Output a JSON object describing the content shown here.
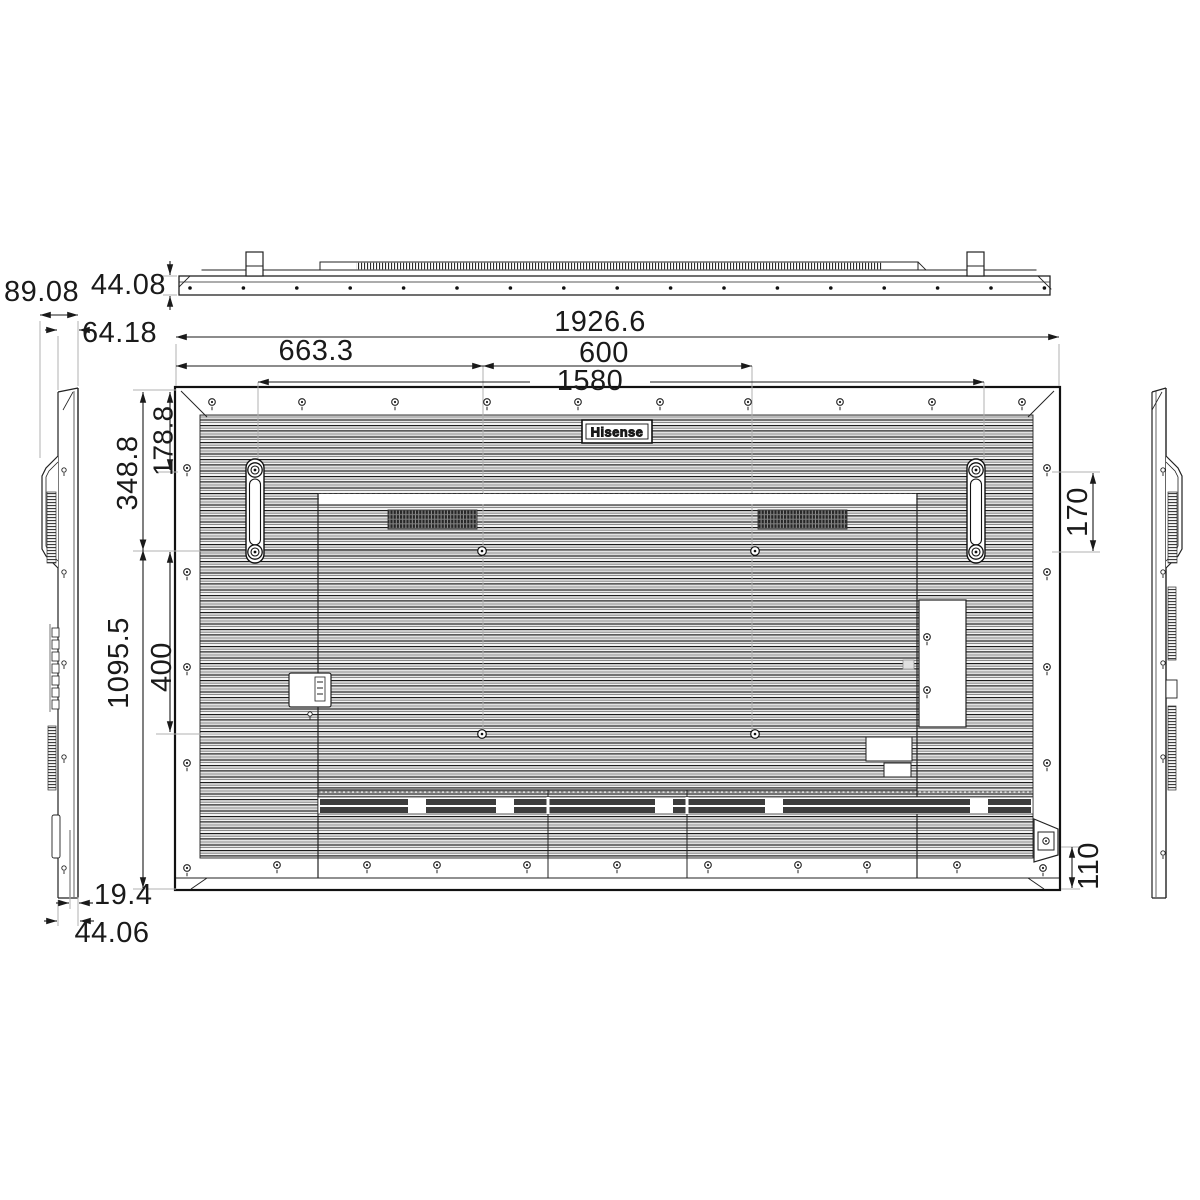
{
  "drawing": {
    "brand": "Hisense",
    "dims": {
      "top_thickness": "44.08",
      "side_depth_overall": "89.08",
      "side_depth_body": "64.18",
      "overall_width": "1926.6",
      "edge_to_vesa": "663.3",
      "vesa_width": "600",
      "handle_span": "1580",
      "top_to_handle_hole": "178.8",
      "top_to_vesa": "348.8",
      "vesa_height": "400",
      "overall_height": "1095.5",
      "handle_hole_pitch": "170",
      "inlet_from_bottom": "110",
      "bottom_inset": "19.4",
      "bottom_depth": "44.06"
    },
    "colors": {
      "ink": "#1a1a1a",
      "paper": "#ffffff"
    }
  }
}
